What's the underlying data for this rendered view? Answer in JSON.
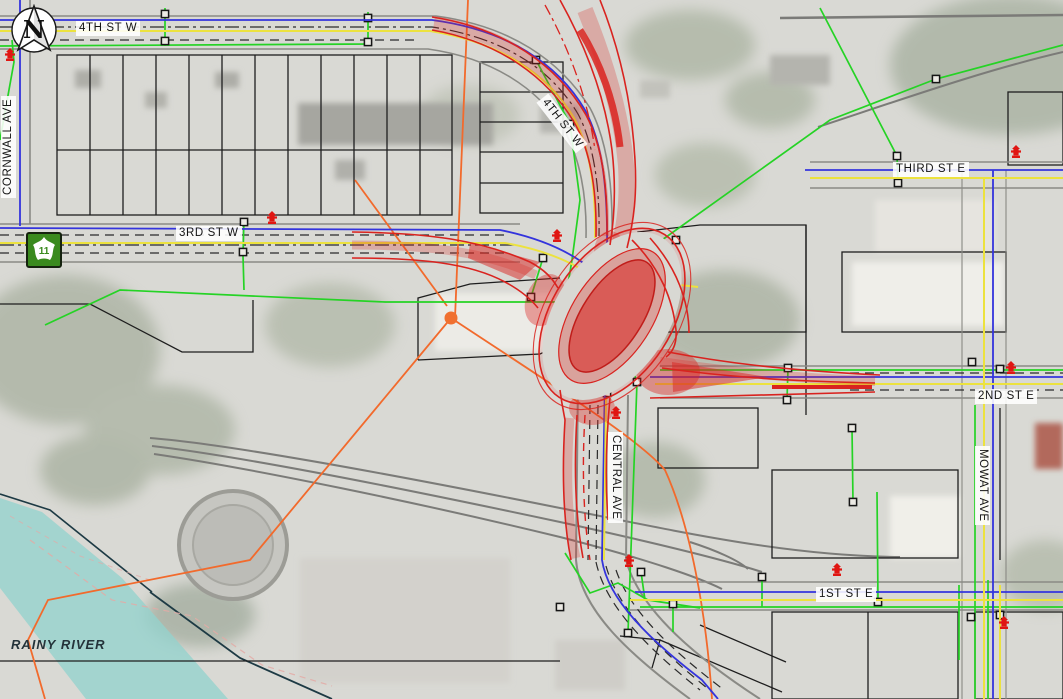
{
  "document": {
    "kind": "engineering-design-plan-over-aerial-photo"
  },
  "north_arrow": {
    "letter": "N"
  },
  "highway_shield": {
    "route_number": "11"
  },
  "street_labels": {
    "fourth_st_w_top": "4TH ST W",
    "fourth_st_w_curve": "4TH ST W",
    "cornwall_ave": "CORNWALL AVE",
    "third_st_w": "3RD ST W",
    "third_st_e": "THIRD ST E",
    "second_st_e": "2ND ST E",
    "central_ave": "CENTRAL AVE",
    "mowat_ave": "MOWAT AVE",
    "first_st_e": "1ST ST E"
  },
  "water_labels": {
    "rainy_river": "RAINY RIVER"
  },
  "palette": {
    "proposed_road_red": "#d9231f",
    "watermain_blue": "#3434dd",
    "lane_yellow": "#ece23e",
    "gas_green": "#25d325",
    "hydro_orange": "#f26a2c",
    "rail_gray": "#7b7b78",
    "parcel_black": "#1e1e1e",
    "river_teal": "#93d2cd",
    "hydrant_red": "#e01612"
  },
  "symbols": {
    "fire_hydrant": "fire-hydrant-icon",
    "utility_node": "utility-node-icon",
    "north_arrow": "north-arrow-icon",
    "highway_shield": "highway-11-shield-icon"
  }
}
